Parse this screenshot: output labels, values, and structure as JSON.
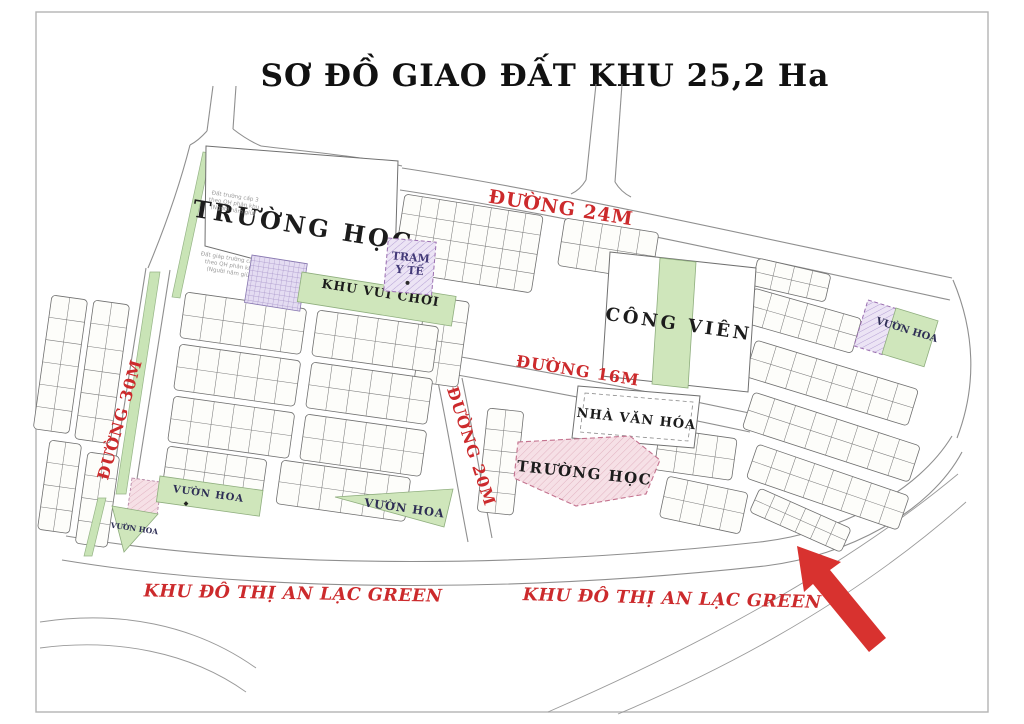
{
  "title": "SƠ ĐỒ GIAO ĐẤT KHU 25,2 Ha",
  "roads": {
    "r24": "ĐƯỜNG 24M",
    "r16": "ĐƯỜNG 16M",
    "r30": "ĐƯỜNG 30M",
    "r20": "ĐƯỜNG 20M"
  },
  "zones": {
    "school_top": "TRƯỜNG HỌC",
    "school_bottom": "TRƯỜNG HỌC",
    "park": "CÔNG VIÊN",
    "culture_house": "NHÀ VĂN HÓA",
    "health_l1": "TRẠM",
    "health_l2": "Y TẾ",
    "playground": "KHU VUI CHƠI",
    "gardens": [
      "VƯỜN HOA",
      "VƯỜN HOA",
      "VƯỜN HOA",
      "VƯỜN HOA"
    ]
  },
  "district": {
    "left": "KHU ĐÔ THỊ AN LẠC GREEN",
    "right": "KHU ĐÔ THỊ AN LẠC GREEN"
  },
  "notes": {
    "n1_l1": "Đất trường cấp 3",
    "n1_l2": "theo QH phân khu",
    "n1_l3": "(Người năm giữ)",
    "n2_l1": "Đất giáp trường cấp 3",
    "n2_l2": "theo QH phân khu",
    "n2_l3": "(Người năm giữ)"
  },
  "icons": {
    "pointer_arrow": "red-arrow-up-left",
    "garden_symbol": "tree-marker",
    "health_symbol": "dot-marker"
  },
  "colors": {
    "accent_red": "#cc2a2c",
    "arrow_red": "#d8322f",
    "map_green": "#cfe6bb",
    "purple_fill": "#ece4f5",
    "purple_line": "#9a6fb0",
    "pink_fill": "#f6e0e6",
    "pink_line": "#c4738f",
    "road_line": "#8f8f8f",
    "ink": "#1c1c1c",
    "navy": "#2e2e55"
  }
}
